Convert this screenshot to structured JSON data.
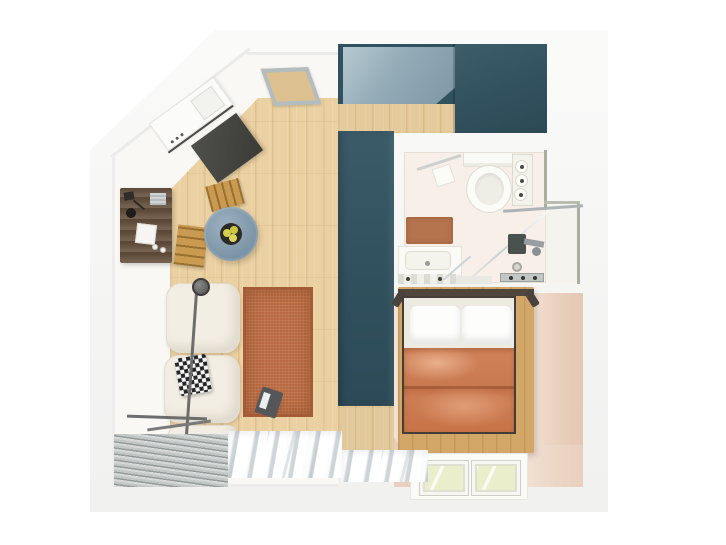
{
  "scene": {
    "title": "Studio apartment floor plan - top-down 3D render",
    "view": "top-down",
    "background": "#ffffff",
    "shape_note": "square footprint with chamfered top-left corner"
  },
  "palette": {
    "wall_white": "#f6f6f5",
    "wood_floor_oak": "#ebd1a2",
    "cabinet_teal": "#32515e",
    "kitchen_shadow_blue": "#93abb7",
    "rug_terracotta": "#b8693f",
    "duvet_terracotta": "#cd7d54",
    "bedroom_floor_blush": "#f1e1d4",
    "sofa_cream": "#f3eee3",
    "table_blue_gray": "#7e97a9",
    "chair_oak": "#c99a4f",
    "sideboard_walnut": "#68523f",
    "bathroom_floor": "#f8f0e8",
    "bath_wall_accent": "#a9ae9d",
    "grille_gray": "#969c9b",
    "curtain_white": "#fbfcfc",
    "window_glass_tint": "#ebeecb",
    "lemon_yellow": "#d6cf4a"
  },
  "rooms": [
    {
      "name": "living-room",
      "items": [
        "angled white desk",
        "dark chair mat",
        "skylight panel",
        "walnut sideboard with decor",
        "round blue-gray table",
        "fruit bowl with lemons",
        "oak chair top",
        "oak chair left",
        "white modular sofa",
        "black-white patterned pillow",
        "arc floor lamp",
        "terracotta rug",
        "portable radio",
        "floor vent grille",
        "sheer white curtains"
      ]
    },
    {
      "name": "kitchen",
      "items": [
        "teal corner cabinets",
        "wood countertop"
      ]
    },
    {
      "name": "wardrobe-column",
      "items": [
        "tall teal wardrobe"
      ]
    },
    {
      "name": "bathroom",
      "items": [
        "toilet",
        "towel rail with towel",
        "shelf with toilet rolls",
        "terracotta bath mat",
        "washbasin counter",
        "corner glass shower",
        "shower mixer",
        "floor drain",
        "drain strip"
      ]
    },
    {
      "name": "bedroom",
      "items": [
        "double bed wood frame",
        "two white pillows",
        "terracotta duvet",
        "two floor windows"
      ]
    }
  ]
}
